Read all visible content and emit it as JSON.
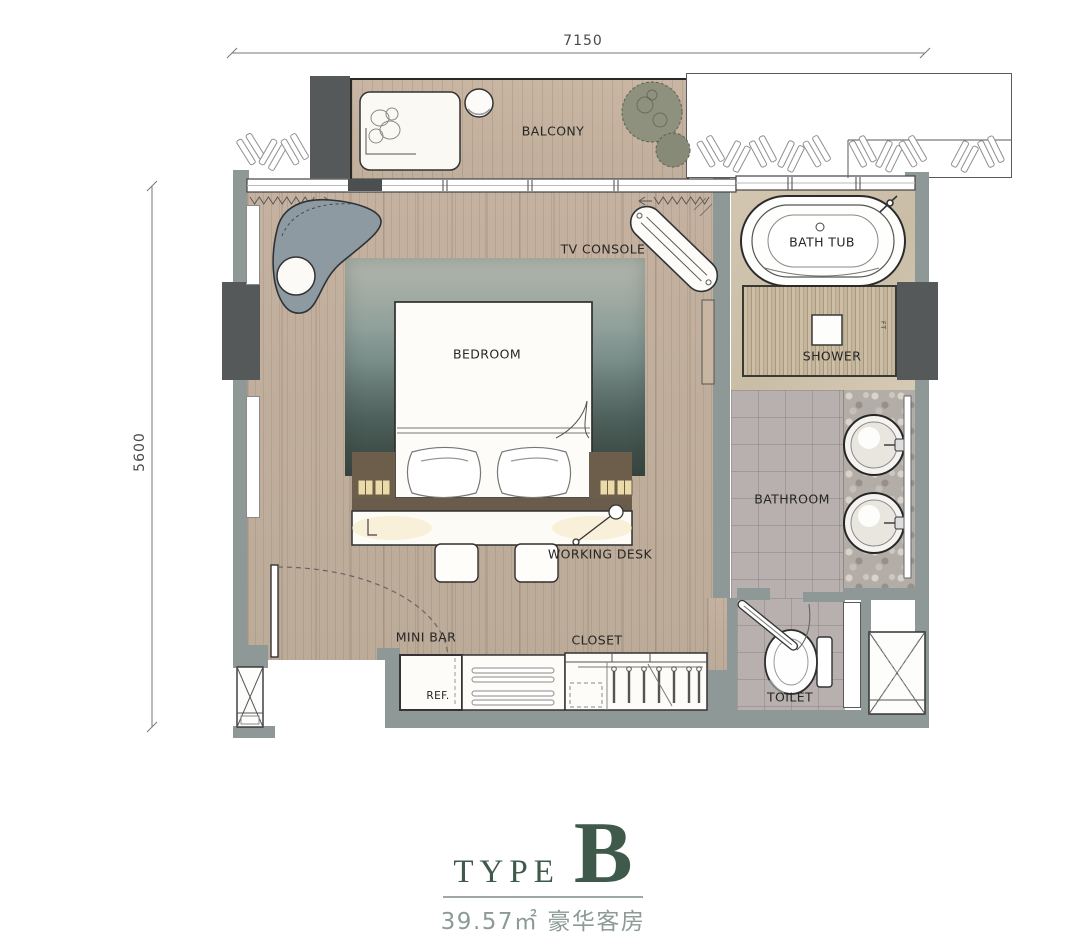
{
  "dimensions": {
    "top": "7150",
    "left": "5600"
  },
  "rooms": {
    "balcony": "BALCONY",
    "bedroom": "BEDROOM",
    "bathroom": "BATHROOM",
    "toilet": "TOILET",
    "shower": "SHOWER",
    "bath_tub": "BATH TUB"
  },
  "furniture": {
    "tv_console": "TV CONSOLE",
    "working_desk": "WORKING DESK",
    "mini_bar": "MINI BAR",
    "closet": "CLOSET",
    "refrigerator": "REF.",
    "shower_note": "FT"
  },
  "title": {
    "type_label": "TYPE",
    "type_letter": "B",
    "area_caption": "39.57㎡ 豪华客房"
  },
  "colors": {
    "title_green": "#3f5a4a",
    "subtitle_gray_green": "#8c9b94",
    "wall_gray": "#8e9897",
    "column_dark": "#55595a",
    "wood_floor": "#c2b09e",
    "marble": "#d0c3ae",
    "tile_gray": "#b6afad",
    "rug_dark": "#41504b",
    "outline": "#2f3336"
  }
}
